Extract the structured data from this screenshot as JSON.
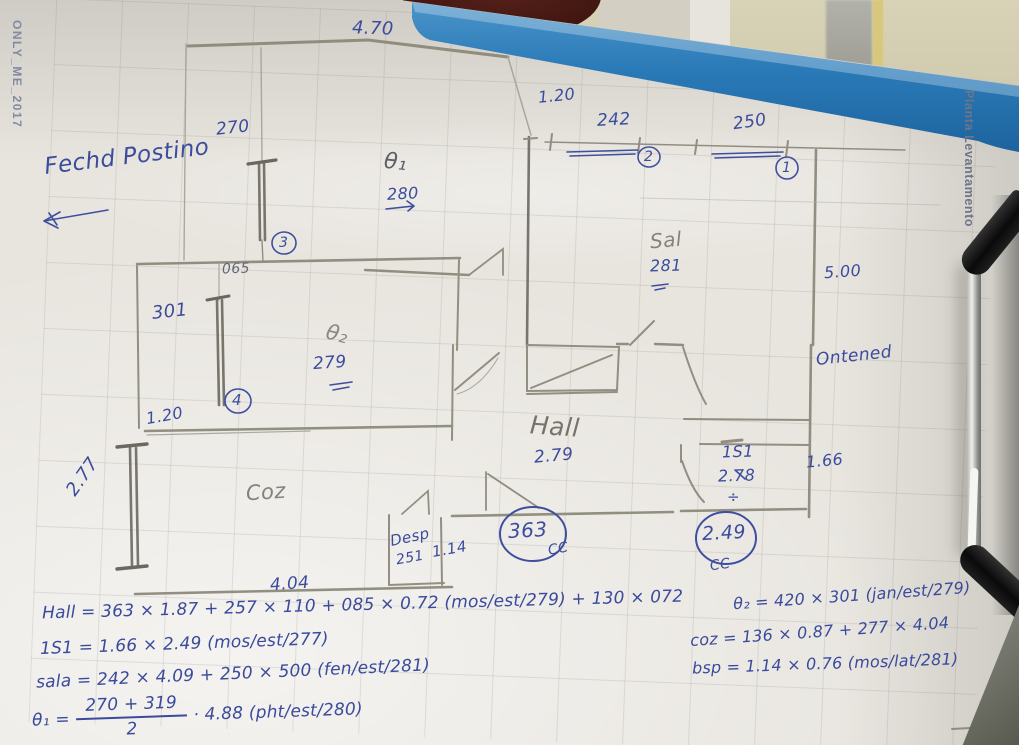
{
  "photo": {
    "watermark": "ONLY_ME_2017",
    "side_label": "Planta Levantamento",
    "board_color": "#2a7ab8",
    "ink_color": "#3c4c9d",
    "pencil_color": "#85827a"
  },
  "annotations": {
    "note_top_left": "Fechd Postino",
    "note_right": "Ontened"
  },
  "plan": {
    "dims": {
      "top_width": "4.70",
      "win_270": "270",
      "gap_120_top": "1.20",
      "win_242": "242",
      "win_250": "250",
      "theta1_label": "θ₁",
      "theta1_height": "280",
      "sal_label": "Sal",
      "sal_height": "281",
      "right_height": "5.00",
      "gap_065": "065",
      "win_301": "301",
      "theta2_label": "θ₂",
      "theta2_height": "279",
      "gap_120_left": "1.20",
      "win_277": "2.77",
      "coz_label": "Coz",
      "hall_label": "Hall",
      "hall_height": "2.79",
      "desp_label": "Desp",
      "desp_height": "251",
      "desp_width": "1.14",
      "coz_width": "4.04",
      "hall_width_circled": "363",
      "cc_left": "CC",
      "is1_width_circled": "2.49",
      "cc_right": "CC",
      "is1_label": "1S1",
      "is1_height": "2.78",
      "divide_mark": "÷",
      "is1_width": "1.66"
    },
    "markers": {
      "m1": "1",
      "m2": "2",
      "m3": "3",
      "m4": "4"
    }
  },
  "formulas": {
    "hall": "Hall = 363 × 1.87 + 257 × 110 + 085 × 0.72 (mos/est/279) + 130 × 072",
    "is1": "1S1 = 1.66 × 2.49 (mos/est/277)",
    "sala": "sala = 242 × 4.09 + 250 × 500 (fen/est/281)",
    "theta1_label": "θ₁ =",
    "theta1_num": "270 + 319",
    "theta1_den": "2",
    "theta1_rest": "· 4.88 (pht/est/280)",
    "theta2": "θ₂ = 420 × 301 (jan/est/279)",
    "coz": "coz = 136 × 0.87 + 277 × 4.04",
    "bsp": "bsp = 1.14 × 0.76 (mos/lat/281)"
  }
}
